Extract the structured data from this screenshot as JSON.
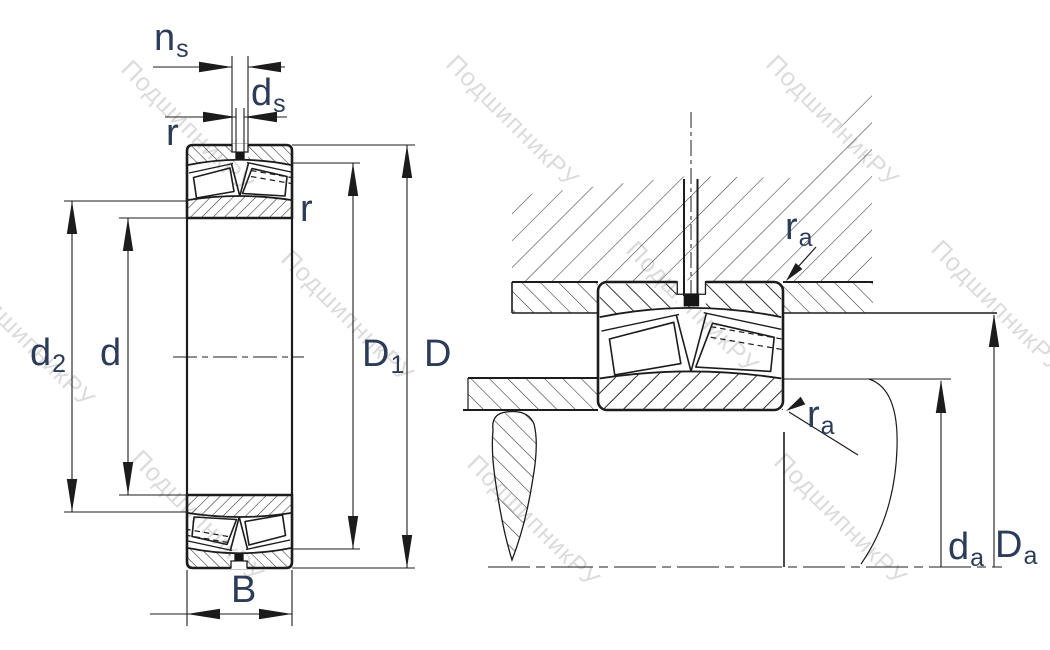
{
  "drawing": {
    "type": "bearing-technical-drawing",
    "views": [
      "bearing-cross-section",
      "mounting-abutment-section"
    ]
  },
  "labels": {
    "ns": {
      "main": "n",
      "sub": "s"
    },
    "ds": {
      "main": "d",
      "sub": "s"
    },
    "r_outer": {
      "main": "r",
      "sub": ""
    },
    "r_inner": {
      "main": "r",
      "sub": ""
    },
    "d2": {
      "main": "d",
      "sub": "2"
    },
    "d": {
      "main": "d",
      "sub": ""
    },
    "D1": {
      "main": "D",
      "sub": "1"
    },
    "D": {
      "main": "D",
      "sub": ""
    },
    "B": {
      "main": "B",
      "sub": ""
    },
    "ra_top": {
      "main": "r",
      "sub": "a"
    },
    "ra_bot": {
      "main": "r",
      "sub": "a"
    },
    "da": {
      "main": "d",
      "sub": "a"
    },
    "Da": {
      "main": "D",
      "sub": "a"
    }
  },
  "watermark": {
    "text": "ПодшипникРУ"
  },
  "colors": {
    "label_color": "#2c3c58",
    "line_color": "#1c1c1c",
    "watermark_color": "rgba(0,0,0,0.14)",
    "background": "#ffffff"
  }
}
